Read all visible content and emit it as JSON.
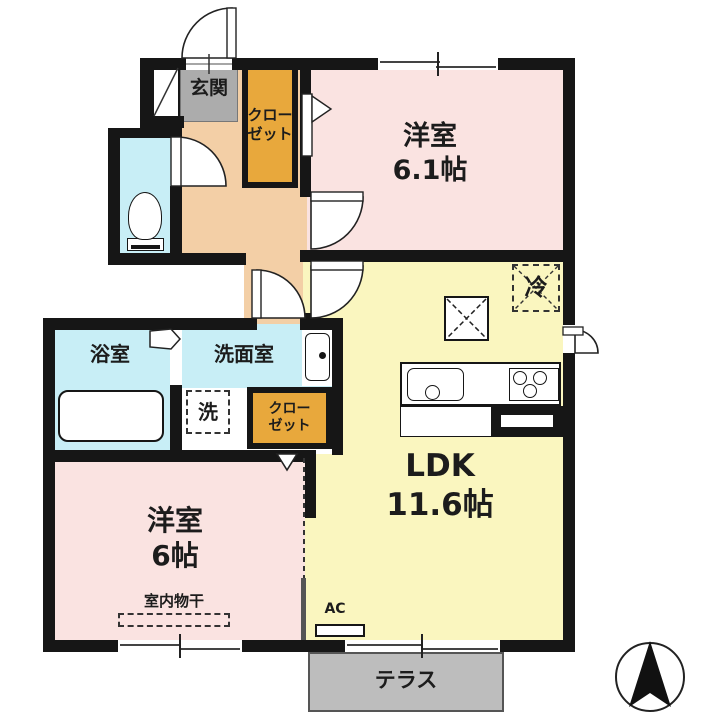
{
  "plan": {
    "title": "apartment-floor-plan",
    "rooms": {
      "genkan": {
        "label": "玄関"
      },
      "closet_top": {
        "line1": "クロー",
        "line2": "ゼット"
      },
      "bedroom1": {
        "name": "洋室",
        "size": "6.1帖"
      },
      "ldk": {
        "name": "LDK",
        "size": "11.6帖"
      },
      "bath": {
        "label": "浴室"
      },
      "washroom": {
        "label": "洗面室"
      },
      "laundry": {
        "label": "洗"
      },
      "closet_bottom": {
        "line1": "クロー",
        "line2": "ゼット"
      },
      "bedroom2": {
        "name": "洋室",
        "size": "6帖"
      },
      "terrace": {
        "label": "テラス"
      }
    },
    "annotations": {
      "refrigerator": "冷",
      "ac": "AC",
      "indoor_drying": "室内物干"
    },
    "colors": {
      "wall": "#161616",
      "hall": "#f3cfa6",
      "bedroom": "#fae3e1",
      "ldk": "#faf6bf",
      "wet_area": "#c8eef6",
      "closet": "#e8a83c",
      "genkan": "#acacac",
      "terrace": "#bdbdbd",
      "background": "#ffffff"
    }
  }
}
